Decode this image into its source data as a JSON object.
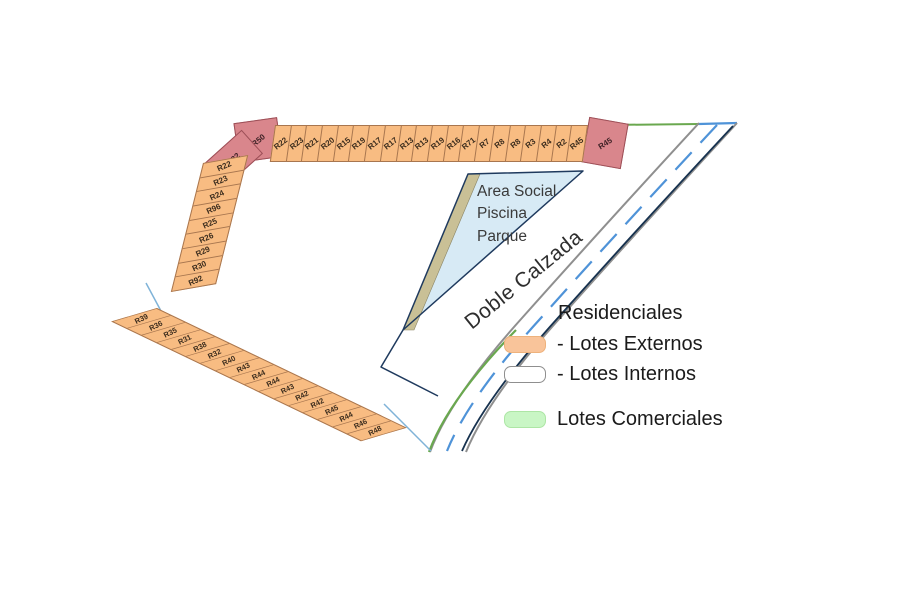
{
  "map": {
    "corners": {
      "top_left_upper": "R50",
      "top_left_lower": "R22",
      "top_right": "R45"
    },
    "top_row": [
      "R22",
      "R23",
      "R21",
      "R20",
      "R15",
      "R19",
      "R17",
      "R17",
      "R13",
      "R13",
      "R19",
      "R16",
      "R71",
      "R7",
      "R8",
      "R8",
      "R3",
      "R4",
      "R2",
      "R45"
    ],
    "left_column": [
      "R22",
      "R23",
      "R24",
      "R96",
      "R25",
      "R26",
      "R29",
      "R30",
      "R92"
    ],
    "bottom_row": [
      "R39",
      "R36",
      "R35",
      "R31",
      "R38",
      "R32",
      "R40",
      "R43",
      "R44",
      "R44",
      "R43",
      "R42",
      "R42",
      "R45",
      "R44",
      "R46",
      "R48"
    ],
    "area_social_lines": [
      "Area Social",
      "Piscina",
      "Parque"
    ],
    "road_label": "Doble Calzada"
  },
  "legend": {
    "title": "Residenciales",
    "items": [
      {
        "label": "- Lotes Externos",
        "swatch": "#f9c49a",
        "border": "1px solid #eeb27c"
      },
      {
        "label": "- Lotes Internos",
        "swatch": "#ffffff",
        "border": "1.5px solid #8f8f8f"
      },
      {
        "label": "Lotes Comerciales",
        "swatch": "#c9f6c5",
        "border": "1px solid #ade6a5"
      }
    ]
  },
  "colors": {
    "lot_external_fill": "#f8bc82",
    "lot_reserved_fill": "#d9868c",
    "area_social_fill": "#d7eaf5",
    "area_social_band": "#c9c096",
    "road_edge_gray": "#8f8f8f",
    "road_line_navy": "#17324f",
    "road_median_blue": "#4f93d8",
    "commercial_edge_green": "#6aa84f"
  }
}
